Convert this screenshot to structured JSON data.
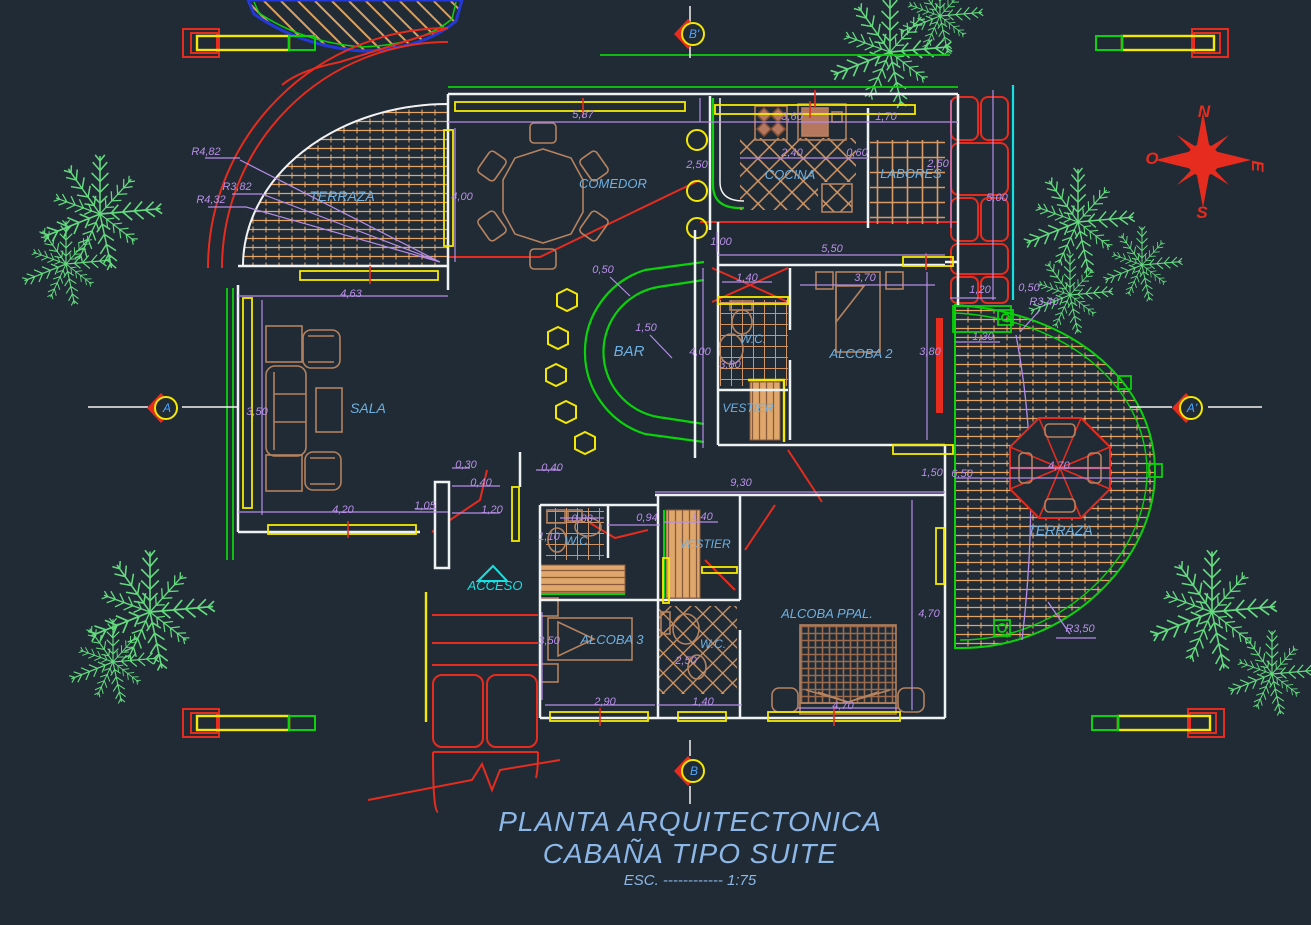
{
  "title": {
    "line1": "PLANTA ARQUITECTONICA",
    "line2": "CABAÑA TIPO SUITE",
    "scale": "ESC. ------------ 1:75"
  },
  "colors": {
    "room": "#6fb0e0",
    "dim": "#b98fe8",
    "red": "#e62c1e",
    "mark": "#4da6ff",
    "cyan": "#18e0e0",
    "title": "#8cb7e6"
  },
  "compass": {
    "north": "N",
    "south": "S",
    "east": "E",
    "west": "O"
  },
  "section_markers": [
    "B'",
    "B",
    "A",
    "A'"
  ],
  "labels": [
    {
      "t": "TERRAZA",
      "x": 342,
      "y": 201,
      "s": 14,
      "c": "room",
      "n": "room-label-terraza-left"
    },
    {
      "t": "COMEDOR",
      "x": 613,
      "y": 188,
      "s": 13,
      "c": "room",
      "n": "room-label-comedor"
    },
    {
      "t": "COCINA",
      "x": 790,
      "y": 179,
      "s": 13,
      "c": "room",
      "n": "room-label-cocina"
    },
    {
      "t": "LABORES",
      "x": 911,
      "y": 178,
      "s": 13,
      "c": "room",
      "n": "room-label-labores"
    },
    {
      "t": "BAR",
      "x": 629,
      "y": 356,
      "s": 15,
      "c": "room",
      "n": "room-label-bar"
    },
    {
      "t": "SALA",
      "x": 368,
      "y": 413,
      "s": 14,
      "c": "room",
      "n": "room-label-sala"
    },
    {
      "t": "W.C.",
      "x": 753,
      "y": 343,
      "s": 12,
      "c": "room",
      "n": "room-label-wc-top"
    },
    {
      "t": "ALCOBA  2",
      "x": 861,
      "y": 358,
      "s": 13,
      "c": "room",
      "n": "room-label-alcoba2"
    },
    {
      "t": "VESTIER",
      "x": 748,
      "y": 412,
      "s": 12,
      "c": "room",
      "n": "room-label-vestier-top"
    },
    {
      "t": "ACCESO",
      "x": 495,
      "y": 590,
      "s": 13,
      "c": "cyan",
      "n": "room-label-acceso"
    },
    {
      "t": "W.C.",
      "x": 578,
      "y": 545,
      "s": 12,
      "c": "room",
      "n": "room-label-wc-mid"
    },
    {
      "t": "VESTIER",
      "x": 705,
      "y": 548,
      "s": 12,
      "c": "room",
      "n": "room-label-vestier-bottom"
    },
    {
      "t": "ALCOBA  3",
      "x": 612,
      "y": 644,
      "s": 13,
      "c": "room",
      "n": "room-label-alcoba3"
    },
    {
      "t": "W.C.",
      "x": 713,
      "y": 648,
      "s": 12,
      "c": "room",
      "n": "room-label-wc-bottom"
    },
    {
      "t": "ALCOBA PPAL.",
      "x": 827,
      "y": 618,
      "s": 13,
      "c": "room",
      "n": "room-label-alcoba-ppal"
    },
    {
      "t": "TERRAZA",
      "x": 1060,
      "y": 535,
      "s": 14,
      "c": "room",
      "n": "room-label-terraza-right"
    },
    {
      "t": "R4,82",
      "x": 206,
      "y": 155,
      "s": 11,
      "c": "dim",
      "n": "dim-r482"
    },
    {
      "t": "R3,82",
      "x": 237,
      "y": 190,
      "s": 11,
      "c": "dim",
      "n": "dim-r382"
    },
    {
      "t": "R4,32",
      "x": 211,
      "y": 203,
      "s": 11,
      "c": "dim",
      "n": "dim-r432"
    },
    {
      "t": "4,00",
      "x": 462,
      "y": 200,
      "s": 11,
      "c": "dim",
      "n": "dim-400-comedor"
    },
    {
      "t": "4,63",
      "x": 351,
      "y": 297,
      "s": 11,
      "c": "dim",
      "n": "dim-463"
    },
    {
      "t": "5,87",
      "x": 583,
      "y": 118,
      "s": 11,
      "c": "dim",
      "n": "dim-587"
    },
    {
      "t": "2,50",
      "x": 697,
      "y": 168,
      "s": 11,
      "c": "dim",
      "n": "dim-250-columns"
    },
    {
      "t": "1,00",
      "x": 721,
      "y": 245,
      "s": 11,
      "c": "dim",
      "n": "dim-100"
    },
    {
      "t": "3,60",
      "x": 792,
      "y": 120,
      "s": 11,
      "c": "dim",
      "n": "dim-360"
    },
    {
      "t": "1,70",
      "x": 886,
      "y": 120,
      "s": 11,
      "c": "dim",
      "n": "dim-170"
    },
    {
      "t": "2,40",
      "x": 792,
      "y": 156,
      "s": 11,
      "c": "dim",
      "n": "dim-240"
    },
    {
      "t": "0,60",
      "x": 857,
      "y": 156,
      "s": 11,
      "c": "dim",
      "n": "dim-060"
    },
    {
      "t": "2,50",
      "x": 938,
      "y": 167,
      "s": 11,
      "c": "dim",
      "n": "dim-250-labores"
    },
    {
      "t": "5,00",
      "x": 997,
      "y": 201,
      "s": 11,
      "c": "dim",
      "n": "dim-500"
    },
    {
      "t": "1,20",
      "x": 980,
      "y": 293,
      "s": 11,
      "c": "dim",
      "n": "dim-120-right"
    },
    {
      "t": "0,50",
      "x": 1029,
      "y": 291,
      "s": 11,
      "c": "dim",
      "n": "dim-050-right"
    },
    {
      "t": "R3,40",
      "x": 1044,
      "y": 305,
      "s": 11,
      "c": "dim",
      "n": "dim-r340"
    },
    {
      "t": "1,30",
      "x": 983,
      "y": 340,
      "s": 11,
      "c": "dim",
      "n": "dim-130"
    },
    {
      "t": "0,50",
      "x": 603,
      "y": 273,
      "s": 11,
      "c": "dim",
      "n": "dim-050-bar"
    },
    {
      "t": "1,50",
      "x": 646,
      "y": 331,
      "s": 11,
      "c": "dim",
      "n": "dim-150-bar"
    },
    {
      "t": "4,00",
      "x": 700,
      "y": 355,
      "s": 11,
      "c": "dim",
      "n": "dim-400-center"
    },
    {
      "t": "1,40",
      "x": 747,
      "y": 281,
      "s": 11,
      "c": "dim",
      "n": "dim-140-wc"
    },
    {
      "t": "3,80",
      "x": 730,
      "y": 368,
      "s": 11,
      "c": "dim",
      "n": "dim-380-wc"
    },
    {
      "t": "5,50",
      "x": 832,
      "y": 252,
      "s": 11,
      "c": "dim",
      "n": "dim-550"
    },
    {
      "t": "3,70",
      "x": 865,
      "y": 281,
      "s": 11,
      "c": "dim",
      "n": "dim-370"
    },
    {
      "t": "3,80",
      "x": 930,
      "y": 355,
      "s": 11,
      "c": "dim",
      "n": "dim-380-alcoba2"
    },
    {
      "t": "3,50",
      "x": 257,
      "y": 415,
      "s": 11,
      "c": "dim",
      "n": "dim-350-sala"
    },
    {
      "t": "4,20",
      "x": 343,
      "y": 513,
      "s": 11,
      "c": "dim",
      "n": "dim-420"
    },
    {
      "t": "1,05",
      "x": 425,
      "y": 509,
      "s": 11,
      "c": "dim",
      "n": "dim-105"
    },
    {
      "t": "0,30",
      "x": 466,
      "y": 468,
      "s": 11,
      "c": "dim",
      "n": "dim-030"
    },
    {
      "t": "0,40",
      "x": 481,
      "y": 486,
      "s": 11,
      "c": "dim",
      "n": "dim-040-a"
    },
    {
      "t": "0,40",
      "x": 552,
      "y": 471,
      "s": 11,
      "c": "dim",
      "n": "dim-040-b"
    },
    {
      "t": "1,20",
      "x": 492,
      "y": 513,
      "s": 11,
      "c": "dim",
      "n": "dim-120-door"
    },
    {
      "t": "0,88",
      "x": 582,
      "y": 522,
      "s": 11,
      "c": "dim",
      "n": "dim-088"
    },
    {
      "t": "0,94",
      "x": 647,
      "y": 521,
      "s": 11,
      "c": "dim",
      "n": "dim-094"
    },
    {
      "t": "1,10",
      "x": 549,
      "y": 540,
      "s": 11,
      "c": "dim",
      "n": "dim-110"
    },
    {
      "t": "9,30",
      "x": 741,
      "y": 486,
      "s": 11,
      "c": "dim",
      "n": "dim-930"
    },
    {
      "t": "1,40",
      "x": 702,
      "y": 520,
      "s": 11,
      "c": "dim",
      "n": "dim-140-vestier"
    },
    {
      "t": "1,50",
      "x": 932,
      "y": 476,
      "s": 11,
      "c": "dim",
      "n": "dim-150-right"
    },
    {
      "t": "6,50",
      "x": 962,
      "y": 477,
      "s": 11,
      "c": "dim",
      "n": "dim-650"
    },
    {
      "t": "4,70",
      "x": 1059,
      "y": 469,
      "s": 11,
      "c": "dim",
      "n": "dim-470-terraza"
    },
    {
      "t": "R3,50",
      "x": 1080,
      "y": 632,
      "s": 11,
      "c": "dim",
      "n": "dim-r350"
    },
    {
      "t": "3,50",
      "x": 549,
      "y": 644,
      "s": 11,
      "c": "dim",
      "n": "dim-350-alcoba3"
    },
    {
      "t": "2,90",
      "x": 605,
      "y": 705,
      "s": 11,
      "c": "dim",
      "n": "dim-290"
    },
    {
      "t": "2,50",
      "x": 686,
      "y": 664,
      "s": 11,
      "c": "dim",
      "n": "dim-250-wc2"
    },
    {
      "t": "1,40",
      "x": 703,
      "y": 705,
      "s": 11,
      "c": "dim",
      "n": "dim-140-bottom"
    },
    {
      "t": "4,70",
      "x": 929,
      "y": 617,
      "s": 11,
      "c": "dim",
      "n": "dim-470-ppal"
    },
    {
      "t": "4,70",
      "x": 843,
      "y": 709,
      "s": 11,
      "c": "dim",
      "n": "dim-470-bed"
    },
    {
      "t": "A",
      "x": 167,
      "y": 412,
      "s": 12,
      "c": "mark",
      "n": "section-marker-a"
    },
    {
      "t": "A'",
      "x": 1192,
      "y": 412,
      "s": 12,
      "c": "mark",
      "n": "section-marker-a2"
    },
    {
      "t": "B",
      "x": 694,
      "y": 775,
      "s": 12,
      "c": "mark",
      "n": "section-marker-b"
    },
    {
      "t": "B'",
      "x": 694,
      "y": 38,
      "s": 12,
      "c": "mark",
      "n": "section-marker-b2"
    },
    {
      "t": "N",
      "x": 1204,
      "y": 117,
      "s": 17,
      "c": "red",
      "b": 1,
      "n": "compass-north"
    },
    {
      "t": "O",
      "x": 1152,
      "y": 164,
      "s": 17,
      "c": "red",
      "b": 1,
      "n": "compass-west"
    },
    {
      "t": "E",
      "x": 1252,
      "y": 166,
      "s": 17,
      "c": "red",
      "b": 1,
      "r": 90,
      "n": "compass-east"
    },
    {
      "t": "S",
      "x": 1202,
      "y": 218,
      "s": 17,
      "c": "red",
      "b": 1,
      "n": "compass-south"
    }
  ]
}
